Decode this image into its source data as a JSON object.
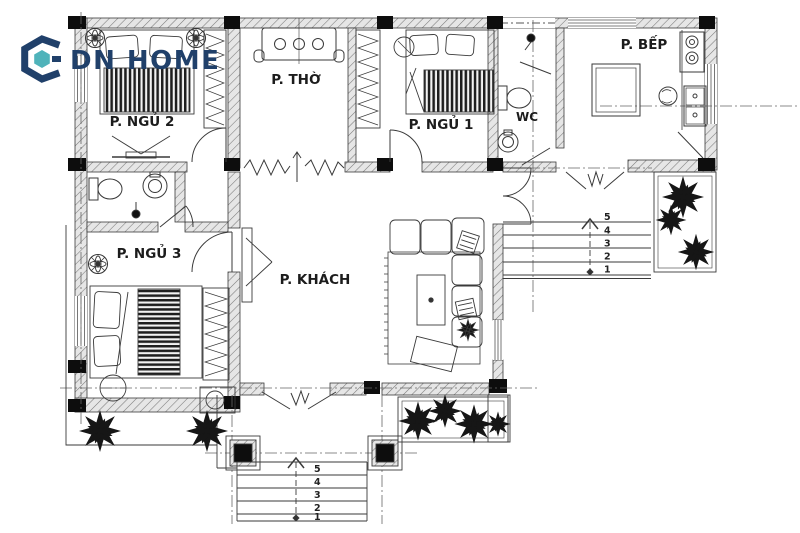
{
  "logo": {
    "text": "DN HOME"
  },
  "rooms": {
    "bedroom2": {
      "label": "P. NGỦ 2"
    },
    "worship": {
      "label": "P. THỜ"
    },
    "bedroom1": {
      "label": "P. NGỦ 1"
    },
    "wc": {
      "label": "WC"
    },
    "kitchen": {
      "label": "P. BẾP"
    },
    "bedroom3": {
      "label": "P. NGỦ 3"
    },
    "living": {
      "label": "P. KHÁCH"
    }
  },
  "stairs": {
    "front": {
      "steps": [
        "1",
        "2",
        "3",
        "4",
        "5"
      ]
    },
    "side": {
      "steps": [
        "1",
        "2",
        "3",
        "4",
        "5"
      ]
    }
  },
  "colors": {
    "navy": "#20406a",
    "teal": "#4fb3ba",
    "line": "#3a3a3a"
  }
}
